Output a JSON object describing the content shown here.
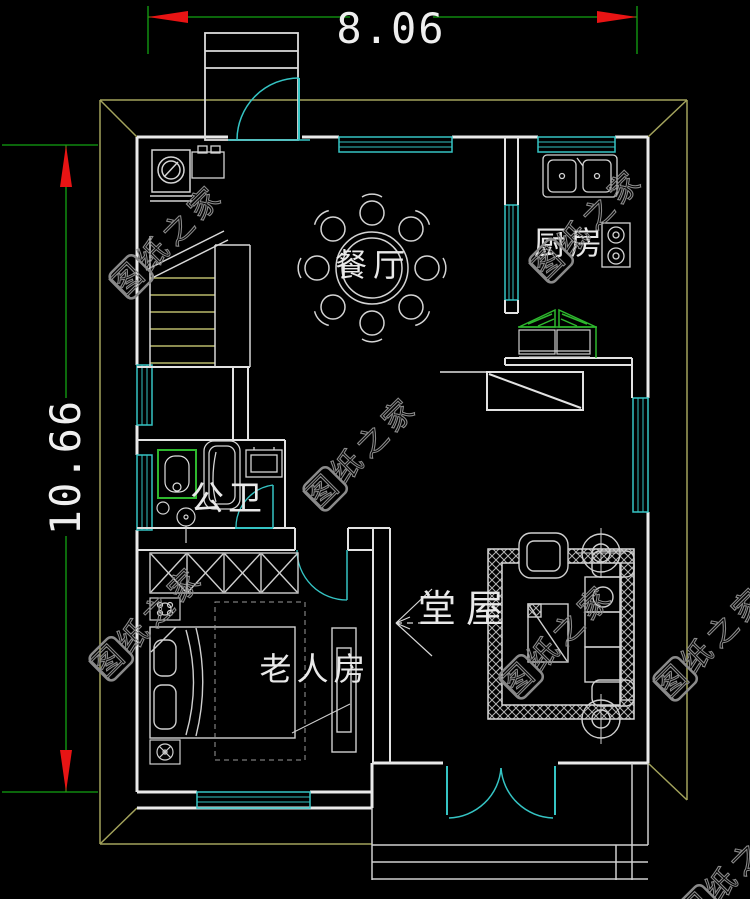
{
  "drawing": {
    "type": "residential-floor-plan",
    "dimensions": {
      "width": "8.06",
      "height": "10.66"
    },
    "rooms": {
      "dining": "餐厅",
      "kitchen": "厨房",
      "bathroom": "公卫",
      "hall": "堂屋",
      "bedroom": "老人房"
    },
    "watermark": {
      "text": "图纸之家"
    },
    "colors": {
      "background": "#000000",
      "wall": "#e9e9e9",
      "furniture": "#cfcfcf",
      "window_door": "#35c4c4",
      "dimension_line": "#12a312",
      "dimension_arrow": "#e81414",
      "roof_eave": "#a3a35c",
      "stair_tread": "#b9b96a",
      "fixture_green": "#2eb82e",
      "watermark": "#8a8a8a",
      "label": "#e9e9e9"
    }
  }
}
